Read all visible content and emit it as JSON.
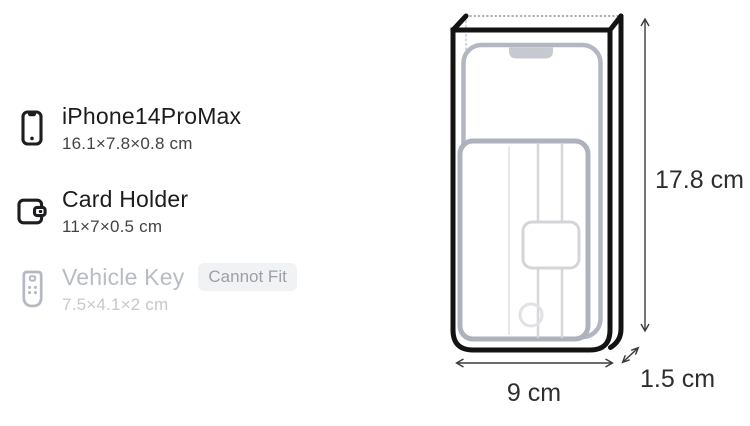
{
  "items": [
    {
      "name": "iPhone14ProMax",
      "dimensions": "16.1×7.8×0.8 cm",
      "icon": "smartphone",
      "fits": true,
      "badge": ""
    },
    {
      "name": "Card Holder",
      "dimensions": "11×7×0.5 cm",
      "icon": "card-holder",
      "fits": true,
      "badge": ""
    },
    {
      "name": "Vehicle Key",
      "dimensions": "7.5×4.1×2 cm",
      "icon": "vehicle-key",
      "fits": false,
      "badge": "Cannot Fit"
    }
  ],
  "pocket": {
    "height_label": "17.8 cm",
    "width_label": "9 cm",
    "depth_label": "1.5 cm"
  },
  "colors": {
    "ink": "#1c1c1e",
    "sub_ink": "#434345",
    "disabled_text": "#b8bcc4",
    "disabled_sub": "#c4c8ce",
    "badge_bg": "#f1f2f4",
    "badge_text": "#9ba0a8",
    "box_outline": "#131313",
    "ghost_outline": "#b3b7bf",
    "dimension_line": "#3a3a3c"
  }
}
